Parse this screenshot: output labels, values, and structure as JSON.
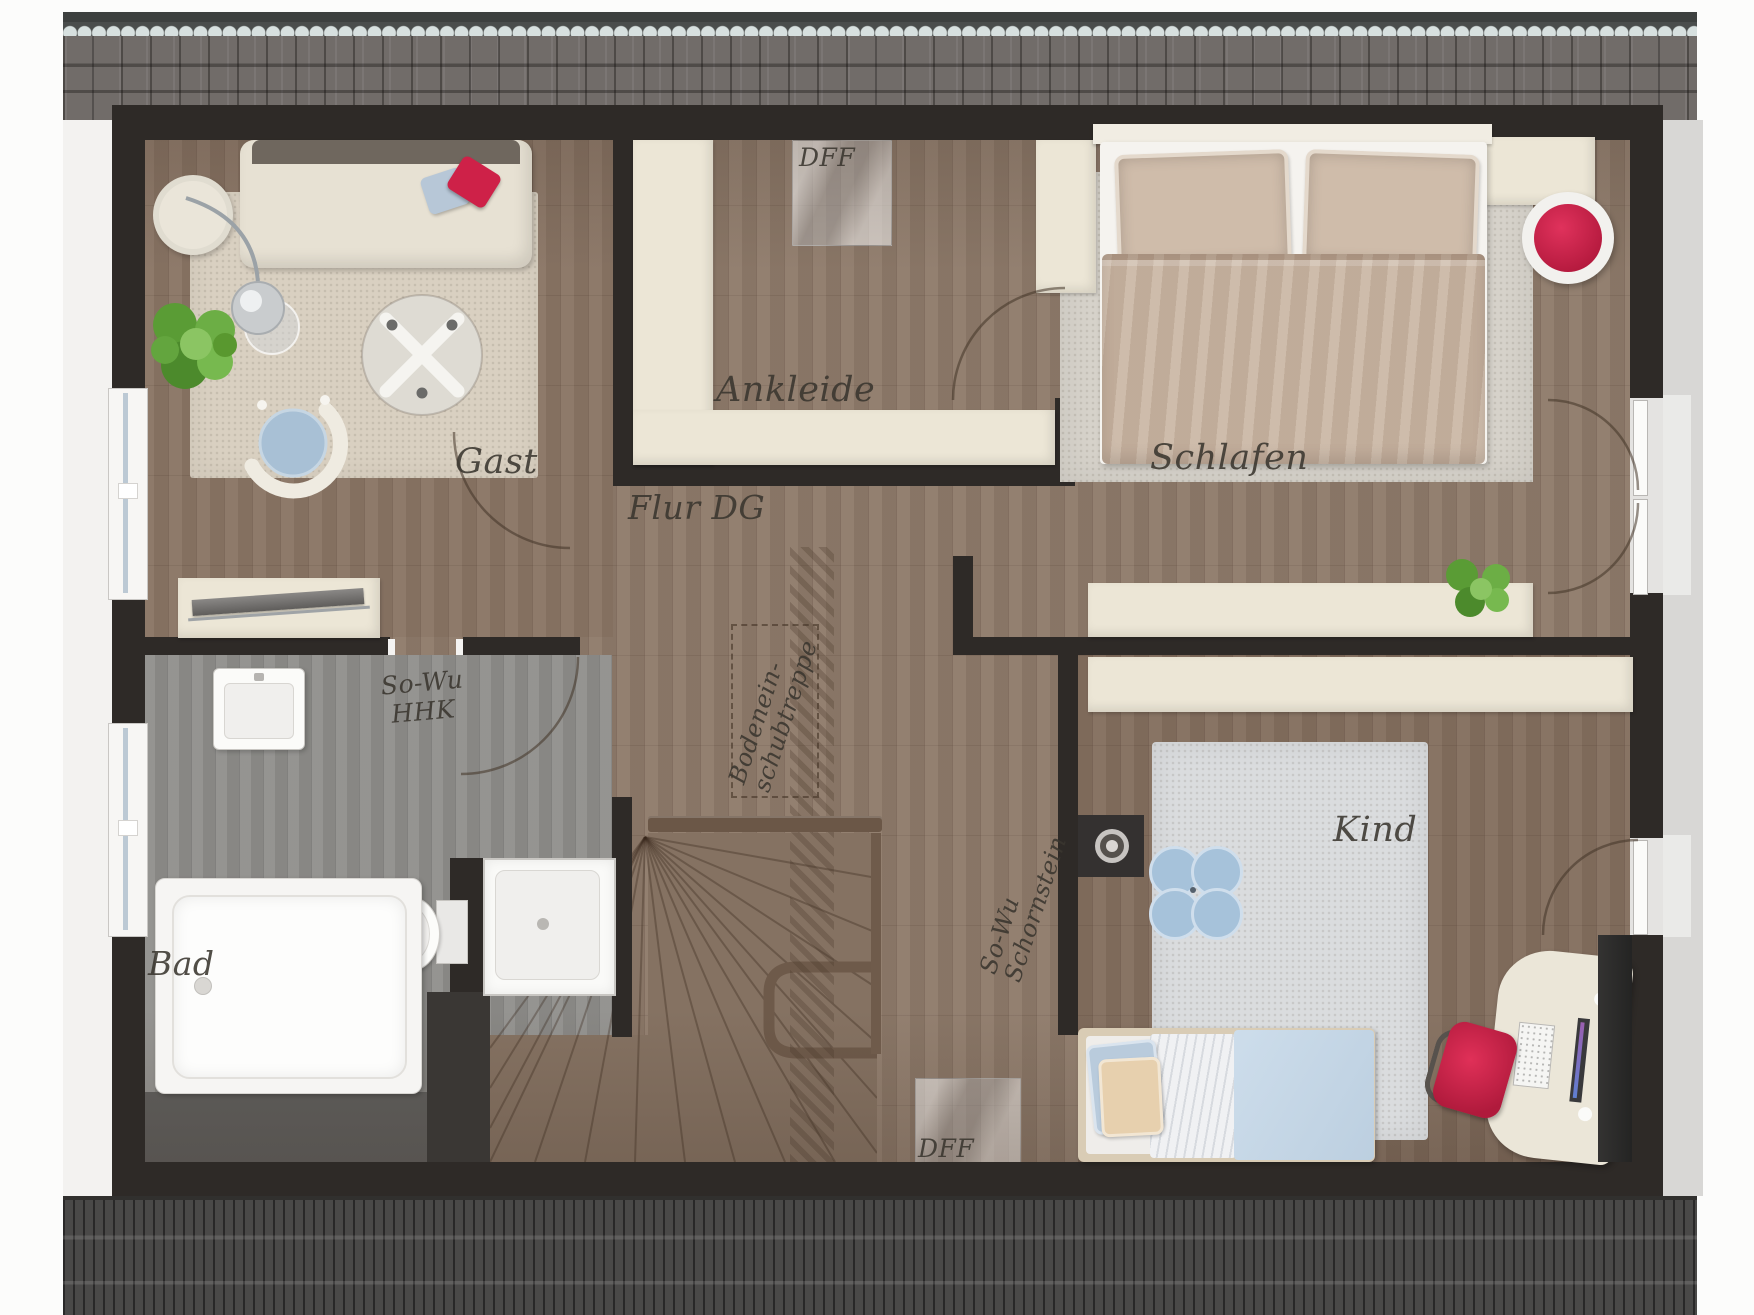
{
  "labels": {
    "gast": "Gast",
    "ankleide": "Ankleide",
    "schlafen": "Schlafen",
    "flur": "Flur DG",
    "bad": "Bad",
    "kind": "Kind",
    "dff": "DFF",
    "sowu_line1": "So-Wu",
    "sowu_line2": "HHK",
    "bodentreppe_line1": "Bodenein-",
    "bodentreppe_line2": "schubtreppe",
    "schornstein_line1": "So-Wu",
    "schornstein_line2": "Schornstein"
  },
  "colors": {
    "wall": "#2e2a27",
    "wood_floor": "#8e7a6a",
    "bad_floor": "#8f8e8b",
    "cream_furniture": "#ece6d6",
    "rug_beige": "#d9d0c1",
    "rug_gray": "#d6d2ca",
    "rug_blue_gray": "#dadcde",
    "accent_red": "#ce2148",
    "accent_blue": "#aac3da",
    "plant_green": "#5a9c35",
    "roof_top": "#716c69",
    "roof_bottom": "#4a4948"
  }
}
